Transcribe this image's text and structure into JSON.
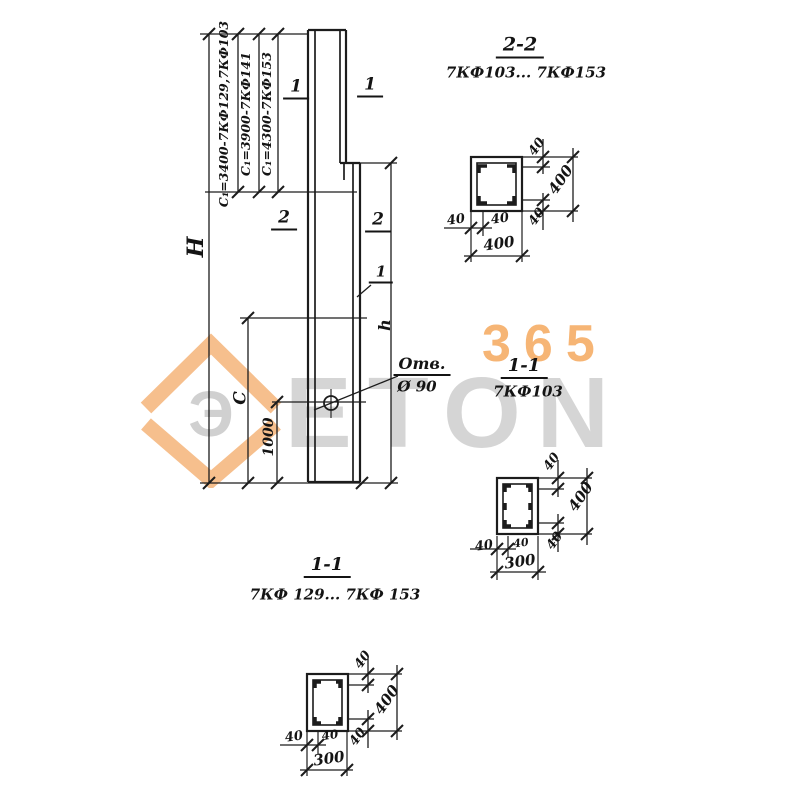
{
  "watermark": {
    "brand": "ETON",
    "number": "365",
    "logo_letter": "Э"
  },
  "elevation": {
    "height_label": "H",
    "c1_dims": [
      "С₁=3400-7КФ129,7КФ103",
      "С₁=3900-7КФ141",
      "С₁=4300-7КФ153"
    ],
    "c_label": "С",
    "hole_offset": "1000",
    "lower_height_label": "h",
    "hole_note_title": "Отв.",
    "hole_note_dia": "Ø 90",
    "cut_marks": {
      "top_left": "1",
      "top_right": "1",
      "mid_left": "2",
      "mid_right": "2",
      "leader": "1"
    }
  },
  "sections": [
    {
      "title": "2-2",
      "subtitle": "7КФ103... 7КФ153",
      "bottom_dims": [
        "40",
        "40",
        "400"
      ],
      "side_dims": [
        "40",
        "400",
        "40"
      ]
    },
    {
      "title": "1-1",
      "subtitle": "7КФ103",
      "bottom_dims": [
        "40",
        "40",
        "300"
      ],
      "side_dims": [
        "40",
        "400",
        "40"
      ]
    },
    {
      "title": "1-1",
      "subtitle": "7КФ 129... 7КФ 153",
      "bottom_dims": [
        "40",
        "40",
        "300"
      ],
      "side_dims": [
        "40",
        "400",
        "40"
      ]
    }
  ]
}
